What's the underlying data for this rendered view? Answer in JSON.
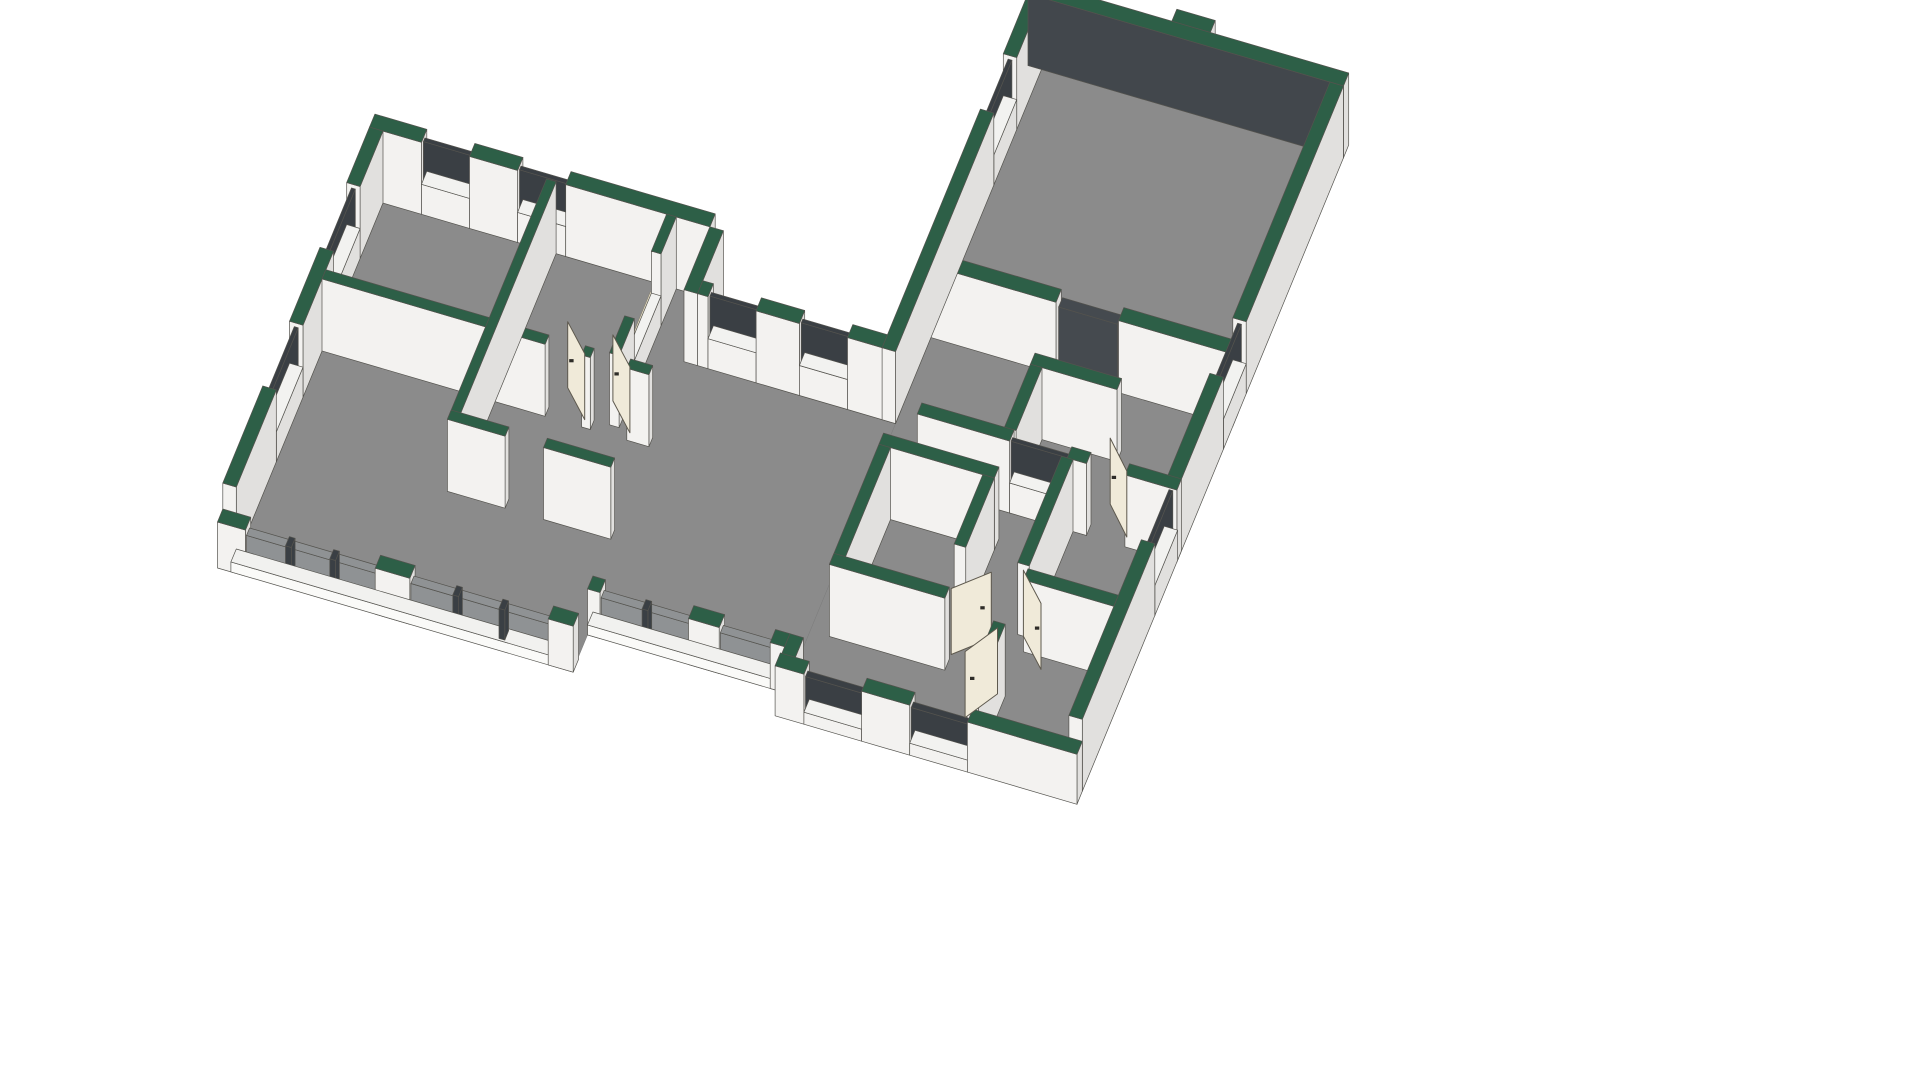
{
  "view": {
    "width": 1920,
    "height": 1080,
    "background": "#ffffff",
    "projection": {
      "ox": 383,
      "oy": 203,
      "ax": 0.9615,
      "ay": 0.2817,
      "bx": -0.3811,
      "by": 0.9246
    }
  },
  "colors": {
    "floor": "#8b8b8b",
    "green": "#2d5f47",
    "wallS": "#f3f2f0",
    "wallE": "#e1e0de",
    "sillTop": "#f2f2f0",
    "slabTop": "#f1f1ef",
    "slabS": "#fafaf8",
    "slabE": "#e6e6e4",
    "pane": "#3a3f44",
    "glass": "#8f9294",
    "opening": "#454a4f",
    "innerDark": "#42474c",
    "cream": "#ebe3ca",
    "white2": "#e9e9e7",
    "door": "#f0ead9",
    "stroke": "#54534e",
    "doorStroke": "#5e594e",
    "handle": "#2e2c28",
    "floorStroke": "#7c7c7c"
  },
  "scene": {
    "floors": [
      {
        "name": "right-wing-floor",
        "pts": [
          [
            560,
            -315
          ],
          [
            860,
            -315
          ],
          [
            860,
            370
          ],
          [
            560,
            370
          ]
        ]
      },
      {
        "name": "left-wing-floor",
        "pts": [
          [
            0,
            0
          ],
          [
            340,
            0
          ],
          [
            340,
            68
          ],
          [
            560,
            68
          ],
          [
            560,
            345
          ],
          [
            355,
            345
          ],
          [
            355,
            385
          ],
          [
            0,
            385
          ]
        ]
      }
    ],
    "elements": [
      {
        "b": [
          -14,
          -14,
          40,
          0
        ],
        "h": 72
      },
      {
        "b": [
          90,
          -14,
          140,
          0
        ],
        "h": 72
      },
      {
        "b": [
          190,
          -14,
          340,
          0
        ],
        "h": 72
      },
      {
        "b": [
          40,
          -14,
          90,
          0
        ],
        "h": 30,
        "t": "sillTop"
      },
      {
        "b": [
          140,
          -14,
          190,
          0
        ],
        "h": 30,
        "t": "sillTop"
      },
      {
        "b": [
          40,
          -9,
          90,
          -5
        ],
        "h0": 30,
        "h": 68,
        "c": "pane"
      },
      {
        "b": [
          140,
          -9,
          190,
          -5
        ],
        "h0": 30,
        "h": 68,
        "c": "pane"
      },
      {
        "b": [
          -14,
          0,
          0,
          60
        ],
        "h": 72
      },
      {
        "b": [
          -14,
          130,
          0,
          210
        ],
        "h": 72
      },
      {
        "b": [
          -14,
          280,
          0,
          385
        ],
        "h": 72
      },
      {
        "b": [
          -14,
          60,
          0,
          130
        ],
        "h": 30,
        "t": "sillTop"
      },
      {
        "b": [
          -14,
          210,
          0,
          280
        ],
        "h": 30,
        "t": "sillTop"
      },
      {
        "b": [
          -9,
          60,
          -5,
          130
        ],
        "h0": 30,
        "h": 68,
        "c": "pane"
      },
      {
        "b": [
          -9,
          210,
          -5,
          280
        ],
        "h0": 30,
        "h": 68,
        "c": "pane"
      },
      {
        "b": [
          170,
          0,
          180,
          260
        ],
        "h": 72
      },
      {
        "b": [
          295,
          0,
          305,
          40
        ],
        "h": 72
      },
      {
        "b": [
          295,
          110,
          305,
          150
        ],
        "h": 72
      },
      {
        "b": [
          295,
          40,
          305,
          110
        ],
        "h": 30,
        "t": "sillTop"
      },
      {
        "f": [
          294,
          40,
          306,
          110
        ],
        "z": 31,
        "c": "cream"
      },
      {
        "b": [
          0,
          150,
          232,
          160
        ],
        "h": 72
      },
      {
        "b": [
          270,
          150,
          279,
          160
        ],
        "h": 72
      },
      {
        "b": [
          317,
          150,
          340,
          160
        ],
        "h": 72
      },
      {
        "b": [
          170,
          250,
          230,
          260
        ],
        "h": 72
      },
      {
        "b": [
          270,
          250,
          340,
          260
        ],
        "h": 72
      },
      {
        "b": [
          340,
          0,
          354,
          68
        ],
        "h": 72
      },
      {
        "b": [
          354,
          54,
          365,
          68
        ],
        "h": 72
      },
      {
        "b": [
          415,
          54,
          460,
          68
        ],
        "h": 72
      },
      {
        "b": [
          510,
          54,
          560,
          68
        ],
        "h": 72
      },
      {
        "b": [
          365,
          54,
          415,
          68
        ],
        "h": 30,
        "t": "sillTop"
      },
      {
        "b": [
          460,
          54,
          510,
          68
        ],
        "h": 30,
        "t": "sillTop"
      },
      {
        "b": [
          365,
          59,
          415,
          63
        ],
        "h0": 30,
        "h": 68,
        "c": "pane"
      },
      {
        "b": [
          460,
          59,
          510,
          63
        ],
        "h0": 30,
        "h": 68,
        "c": "pane"
      },
      {
        "f": [
          363,
          50,
          417,
          63
        ],
        "z": 32,
        "c": "cream"
      },
      {
        "f": [
          458,
          50,
          512,
          63
        ],
        "z": 32,
        "c": "cream"
      },
      {
        "b": [
          546,
          -315,
          560,
          -250
        ],
        "h": 72
      },
      {
        "b": [
          546,
          -190,
          560,
          68
        ],
        "h": 72
      },
      {
        "b": [
          546,
          -250,
          560,
          -190
        ],
        "h": 30,
        "t": "sillTop"
      },
      {
        "b": [
          551,
          -250,
          555,
          -190
        ],
        "h0": 30,
        "h": 68,
        "c": "pane"
      },
      {
        "f": [
          544,
          -252,
          560,
          -188
        ],
        "z": 32,
        "c": "white2"
      },
      {
        "b": [
          546,
          -329,
          874,
          -315
        ],
        "h": 72,
        "s": "innerDark"
      },
      {
        "b": [
          690,
          -342,
          730,
          -329
        ],
        "h": 72
      },
      {
        "b": [
          860,
          -315,
          874,
          -60
        ],
        "h": 72
      },
      {
        "b": [
          860,
          0,
          874,
          120
        ],
        "h": 72
      },
      {
        "b": [
          860,
          180,
          874,
          370
        ],
        "h": 72
      },
      {
        "b": [
          860,
          -60,
          874,
          0
        ],
        "h": 30,
        "t": "sillTop"
      },
      {
        "b": [
          860,
          120,
          874,
          180
        ],
        "h": 30,
        "t": "sillTop"
      },
      {
        "b": [
          865,
          -60,
          869,
          0
        ],
        "h0": 30,
        "h": 68,
        "c": "pane"
      },
      {
        "b": [
          865,
          120,
          869,
          180
        ],
        "h0": 30,
        "h": 68,
        "c": "pane"
      },
      {
        "f": [
          856,
          -58,
          870,
          -2
        ],
        "z": 31,
        "c": "cream"
      },
      {
        "f": [
          856,
          122,
          870,
          178
        ],
        "z": 31,
        "c": "cream"
      },
      {
        "b": [
          560,
          -39,
          690,
          -25
        ],
        "h": 72
      },
      {
        "b": [
          755,
          -39,
          874,
          -25
        ],
        "h": 72
      },
      {
        "b": [
          692,
          -37,
          753,
          -27
        ],
        "h": 66,
        "c": "opening"
      },
      {
        "f": [
          690,
          -39,
          755,
          -25
        ],
        "z": 2,
        "c": "white2"
      },
      {
        "b": [
          690,
          30,
          780,
          42
        ],
        "h": 72
      },
      {
        "b": [
          690,
          42,
          702,
          110
        ],
        "h": 72
      },
      {
        "b": [
          604,
          110,
          700,
          122
        ],
        "h": 72
      },
      {
        "b": [
          760,
          110,
          780,
          122
        ],
        "h": 72
      },
      {
        "b": [
          820,
          110,
          874,
          122
        ],
        "h": 72
      },
      {
        "b": [
          700,
          110,
          760,
          122
        ],
        "h": 30,
        "t": "sillTop"
      },
      {
        "b": [
          700,
          114,
          760,
          118
        ],
        "h0": 30,
        "h": 68,
        "c": "pane"
      },
      {
        "f": [
          698,
          108,
          762,
          121
        ],
        "z": 31,
        "c": "cream"
      },
      {
        "b": [
          580,
          150,
          700,
          162
        ],
        "h": 72
      },
      {
        "b": [
          580,
          162,
          592,
          292
        ],
        "h": 72
      },
      {
        "b": [
          580,
          280,
          700,
          292
        ],
        "h": 72
      },
      {
        "b": [
          688,
          162,
          700,
          237
        ],
        "h": 72
      },
      {
        "b": [
          754,
          122,
          766,
          237
        ],
        "h": 72
      },
      {
        "b": [
          754,
          300,
          766,
          370
        ],
        "h": 72
      },
      {
        "b": [
          766,
          240,
          860,
          252
        ],
        "h": 72
      },
      {
        "b": [
          560,
          370,
          590,
          384
        ],
        "h": 50
      },
      {
        "b": [
          650,
          370,
          700,
          384
        ],
        "h": 50
      },
      {
        "b": [
          760,
          370,
          874,
          384
        ],
        "h": 50
      },
      {
        "b": [
          590,
          370,
          650,
          384
        ],
        "h": 12,
        "t": "sillTop"
      },
      {
        "b": [
          700,
          370,
          760,
          384
        ],
        "h": 12,
        "t": "sillTop"
      },
      {
        "b": [
          590,
          374,
          650,
          380
        ],
        "h0": 12,
        "h": 44,
        "c": "pane"
      },
      {
        "b": [
          700,
          374,
          760,
          380
        ],
        "h0": 12,
        "h": 44,
        "c": "pane"
      },
      {
        "b": [
          560,
          345,
          574,
          370
        ],
        "h": 46
      },
      {
        "b": [
          0,
          385,
          355,
          399
        ],
        "h": 10,
        "t": "slabTop",
        "s": "slabS",
        "e": "slabE"
      },
      {
        "b": [
          -14,
          385,
          15,
          399
        ],
        "h": 46
      },
      {
        "b": [
          150,
          385,
          186,
          399
        ],
        "h": 46
      },
      {
        "b": [
          330,
          385,
          356,
          399
        ],
        "h": 46
      },
      {
        "b": [
          15,
          388,
          150,
          396
        ],
        "h0": 10,
        "h": 38,
        "c": "glass"
      },
      {
        "b": [
          186,
          388,
          330,
          396
        ],
        "h0": 10,
        "h": 38,
        "c": "glass"
      },
      {
        "b": [
          56,
          387,
          62,
          397
        ],
        "h0": 10,
        "h": 40,
        "c": "pane",
        "k": 30
      },
      {
        "b": [
          102,
          387,
          108,
          397
        ],
        "h0": 10,
        "h": 40,
        "c": "pane",
        "k": 30
      },
      {
        "b": [
          230,
          387,
          236,
          397
        ],
        "h0": 10,
        "h": 40,
        "c": "pane",
        "k": 30
      },
      {
        "b": [
          278,
          387,
          284,
          397
        ],
        "h0": 10,
        "h": 40,
        "c": "pane",
        "k": 30
      },
      {
        "b": [
          355,
          345,
          560,
          359
        ],
        "h": 10,
        "t": "slabTop",
        "s": "slabS",
        "e": "slabE"
      },
      {
        "b": [
          355,
          345,
          368,
          359
        ],
        "h": 46
      },
      {
        "b": [
          460,
          345,
          492,
          359
        ],
        "h": 46
      },
      {
        "b": [
          545,
          345,
          560,
          359
        ],
        "h": 46
      },
      {
        "b": [
          368,
          348,
          460,
          356
        ],
        "h0": 10,
        "h": 38,
        "c": "glass"
      },
      {
        "b": [
          492,
          348,
          545,
          356
        ],
        "h0": 10,
        "h": 38,
        "c": "glass"
      },
      {
        "b": [
          411,
          347,
          417,
          357
        ],
        "h0": 10,
        "h": 40,
        "c": "pane",
        "k": 30
      },
      {
        "d": [
          [
            270,
            152
          ],
          [
            242,
            126
          ]
        ],
        "h": 66
      },
      {
        "d": [
          [
            317,
            152
          ],
          [
            289,
            126
          ]
        ],
        "h": 66
      },
      {
        "d": [
          [
            700,
            275
          ],
          [
            731,
            248
          ]
        ],
        "h": 66
      },
      {
        "d": [
          [
            818,
            112
          ],
          [
            790,
            85
          ]
        ],
        "h": 66
      },
      {
        "d": [
          [
            760,
            237
          ],
          [
            789,
            264
          ]
        ],
        "h": 66
      },
      {
        "d": [
          [
            758,
            300
          ],
          [
            737,
            332
          ]
        ],
        "h": 66,
        "z": 820
      }
    ]
  }
}
